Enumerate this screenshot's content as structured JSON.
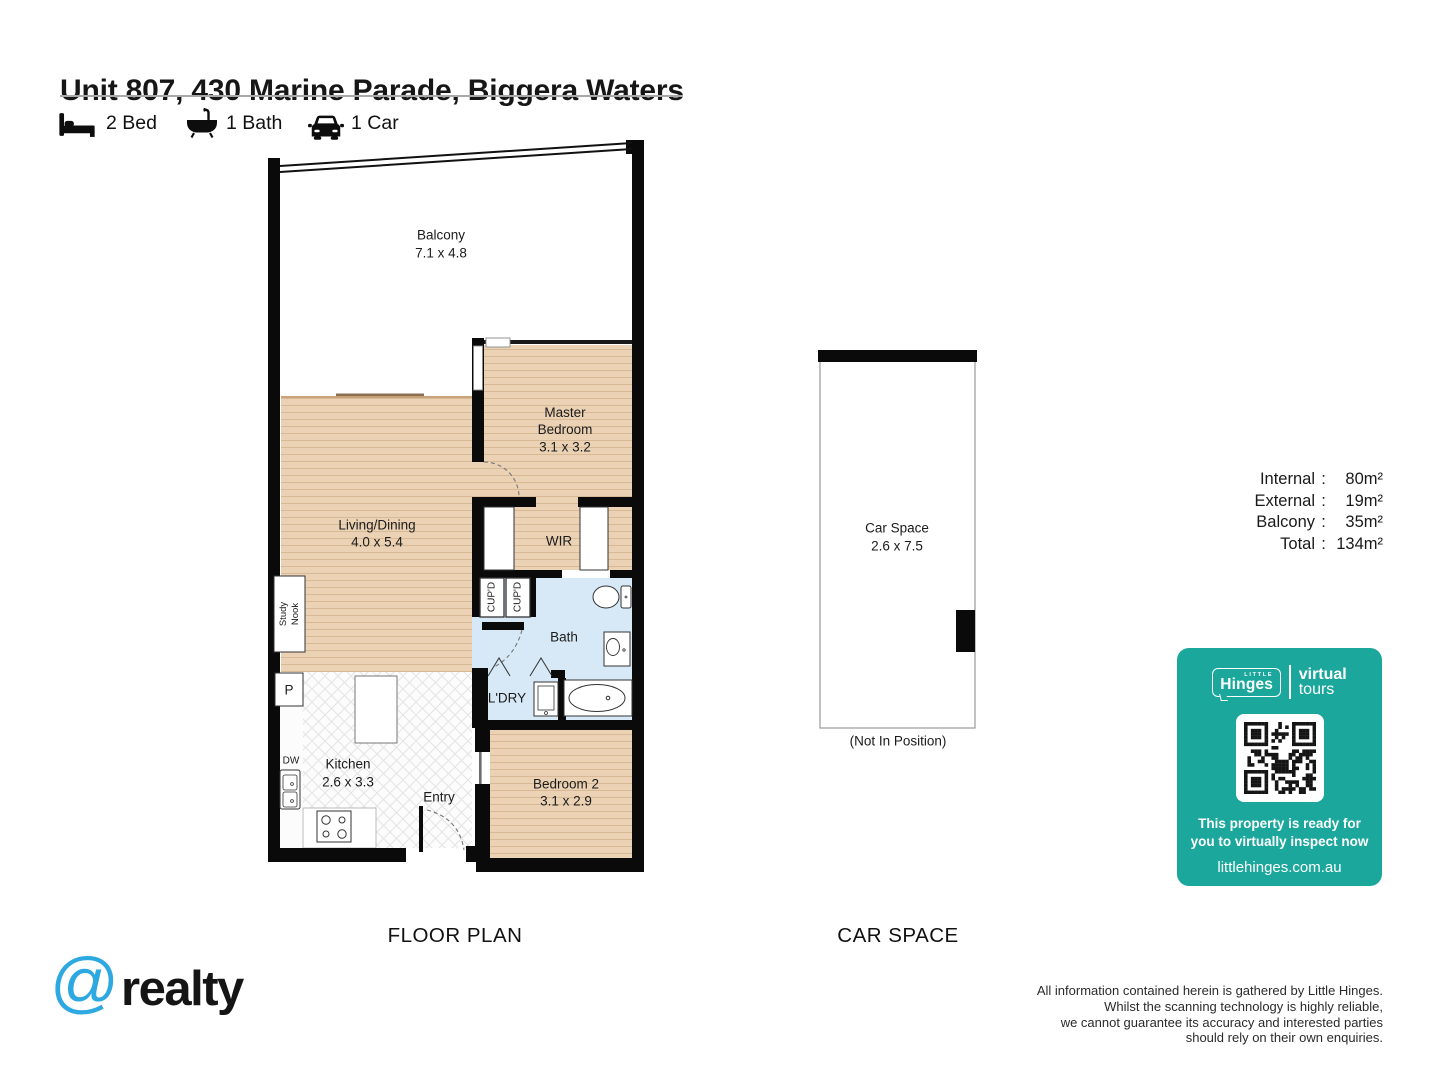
{
  "header": {
    "title": "Unit 807, 430 Marine Parade, Biggera Waters",
    "features": [
      {
        "icon": "bed-icon",
        "label": "2 Bed"
      },
      {
        "icon": "bath-icon",
        "label": "1 Bath"
      },
      {
        "icon": "car-icon",
        "label": "1 Car"
      }
    ]
  },
  "floor_plan": {
    "section_label": "FLOOR PLAN",
    "rooms": {
      "balcony": {
        "name": "Balcony",
        "dims": "7.1 x 4.8"
      },
      "master_bedroom": {
        "name": "Master Bedroom",
        "dims": "3.1 x 3.2"
      },
      "living_dining": {
        "name": "Living/Dining",
        "dims": "4.0 x 5.4"
      },
      "wir": {
        "name": "WIR"
      },
      "bath": {
        "name": "Bath"
      },
      "laundry": {
        "name": "L'DRY"
      },
      "kitchen": {
        "name": "Kitchen",
        "dims": "2.6 x 3.3"
      },
      "bedroom_2": {
        "name": "Bedroom 2",
        "dims": "3.1 x 2.9"
      },
      "entry": {
        "name": "Entry"
      },
      "study_nook": {
        "name": "Study Nook"
      },
      "cupboard_1": {
        "name": "CUP'D"
      },
      "cupboard_2": {
        "name": "CUP'D"
      },
      "pantry": {
        "name": "P"
      },
      "dishwasher": {
        "name": "DW"
      }
    }
  },
  "car_space": {
    "section_label": "CAR SPACE",
    "name": "Car Space",
    "dims": "2.6 x 7.5",
    "note": "(Not In Position)"
  },
  "areas": {
    "colon": ":",
    "rows": [
      {
        "label": "Internal",
        "value": "80m²"
      },
      {
        "label": "External",
        "value": "19m²"
      },
      {
        "label": "Balcony",
        "value": "35m²"
      },
      {
        "label": "Total",
        "value": "134m²"
      }
    ]
  },
  "virtual_tour_badge": {
    "brand_top": "LITTLE",
    "brand": "Hinges",
    "tagline_word1": "virtual",
    "tagline_word2": "tours",
    "message_line1": "This property is ready for",
    "message_line2": "you to virtually inspect now",
    "website": "littlehinges.com.au",
    "background_color": "#1BA79C"
  },
  "footer": {
    "agency_logo_at": "@",
    "agency_logo_text": "realty",
    "agency_logo_color": "#2EA8E1",
    "disclaimer": [
      "All information contained herein is gathered by Little Hinges.",
      "Whilst the scanning technology is highly reliable,",
      "we cannot guarantee its accuracy and interested parties",
      "should rely on their own enquiries."
    ]
  },
  "palette": {
    "wall": "#0a0a0a",
    "wood_floor": "#EBD2B5",
    "wood_floor_line": "#D8B995",
    "wet_area_floor": "#D7E9F6",
    "badge_teal": "#1BA79C",
    "at_blue": "#2EA8E1"
  }
}
